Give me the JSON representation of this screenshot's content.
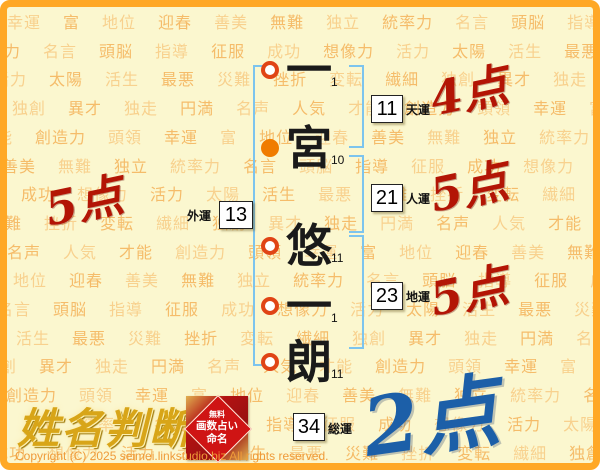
{
  "logo": {
    "title": "姓名判断",
    "badge_lines": [
      "無料",
      "画数占い",
      "命名"
    ]
  },
  "copyright": "Copyright (C) 2025 seimei.linkstudio.biz All rights reserved.",
  "name": {
    "characters": [
      {
        "char": "一",
        "strokes": "1",
        "marker": "hollow"
      },
      {
        "char": "宮",
        "strokes": "10",
        "marker": "filled"
      },
      {
        "char": "悠",
        "strokes": "11",
        "marker": "hollow"
      },
      {
        "char": "一",
        "strokes": "1",
        "marker": "hollow"
      },
      {
        "char": "朗",
        "strokes": "11",
        "marker": "hollow"
      }
    ]
  },
  "fortunes": {
    "tenun": {
      "label": "天運",
      "value": "11",
      "score": "4点"
    },
    "jinun": {
      "label": "人運",
      "value": "21",
      "score": "5点"
    },
    "chiun": {
      "label": "地運",
      "value": "23",
      "score": "5点"
    },
    "gaiun": {
      "label": "外運",
      "value": "13",
      "score": "5点"
    },
    "souun": {
      "label": "総運",
      "value": "34",
      "score": "2点"
    }
  },
  "colors": {
    "frame_orange": "#ffa826",
    "background": "#fbf7cf",
    "word_orange": "#f4ae52",
    "bracket_blue": "#7cc4ee",
    "score_red": "#b31505",
    "score_blue": "#1c5fa8",
    "marker_orange": "#f07c00",
    "marker_ring": "#e04415"
  },
  "background_words": [
    "幸運",
    "富",
    "地位",
    "迎春",
    "善美",
    "無難",
    "独立",
    "統率力",
    "名言",
    "頭脳",
    "指導",
    "征服",
    "成功",
    "想像力",
    "活力",
    "太陽",
    "活生",
    "最悪",
    "災難",
    "挫折",
    "変転",
    "繊細",
    "独創",
    "異才",
    "独走",
    "円満",
    "名声",
    "人気",
    "才能",
    "創造力",
    "頭領"
  ]
}
